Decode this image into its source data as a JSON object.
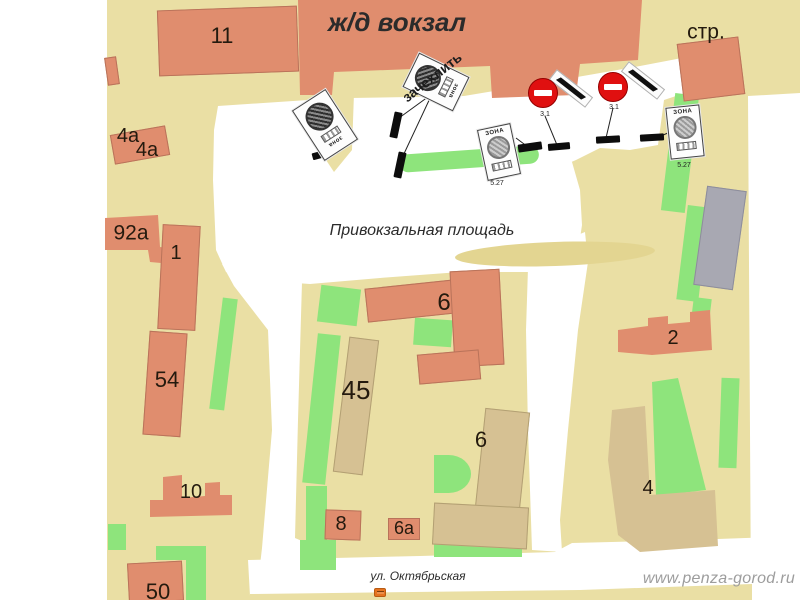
{
  "page": {
    "watermark": "www.penza-gorod.ru"
  },
  "map": {
    "station_title": "ж/д вокзал",
    "square_label": "Привокзальная площадь",
    "street_label": "ул. Октябрьская",
    "construction_label": "стр.",
    "annotation": "зачехлить"
  },
  "buildings": [
    {
      "label": "11"
    },
    {
      "label": "4а"
    },
    {
      "label": "4а"
    },
    {
      "label": "92а"
    },
    {
      "label": "1"
    },
    {
      "label": "54"
    },
    {
      "label": "10"
    },
    {
      "label": "50"
    },
    {
      "label": "45"
    },
    {
      "label": "6"
    },
    {
      "label": "6"
    },
    {
      "label": "8"
    },
    {
      "label": "6а"
    },
    {
      "label": "2"
    },
    {
      "label": "4"
    }
  ],
  "signs": {
    "no_entry_1": {
      "code": "3.1"
    },
    "no_entry_2": {
      "code": "3.1"
    },
    "zone_1": {
      "title": "ЗОНА",
      "code": "5.27"
    },
    "zone_2": {
      "title": "ЗОНА",
      "code": "5.27"
    },
    "zone_rotated_1": {
      "title": "зона"
    },
    "zone_rotated_2": {
      "title": "зона"
    }
  },
  "colors": {
    "land": "#eadfa4",
    "building_residential": "#e08d6e",
    "building_public": "#d6c193",
    "building_gray": "#a8a8b2",
    "greenery": "#8ee47c",
    "road": "#ffffff",
    "no_entry_red": "#e01010"
  }
}
